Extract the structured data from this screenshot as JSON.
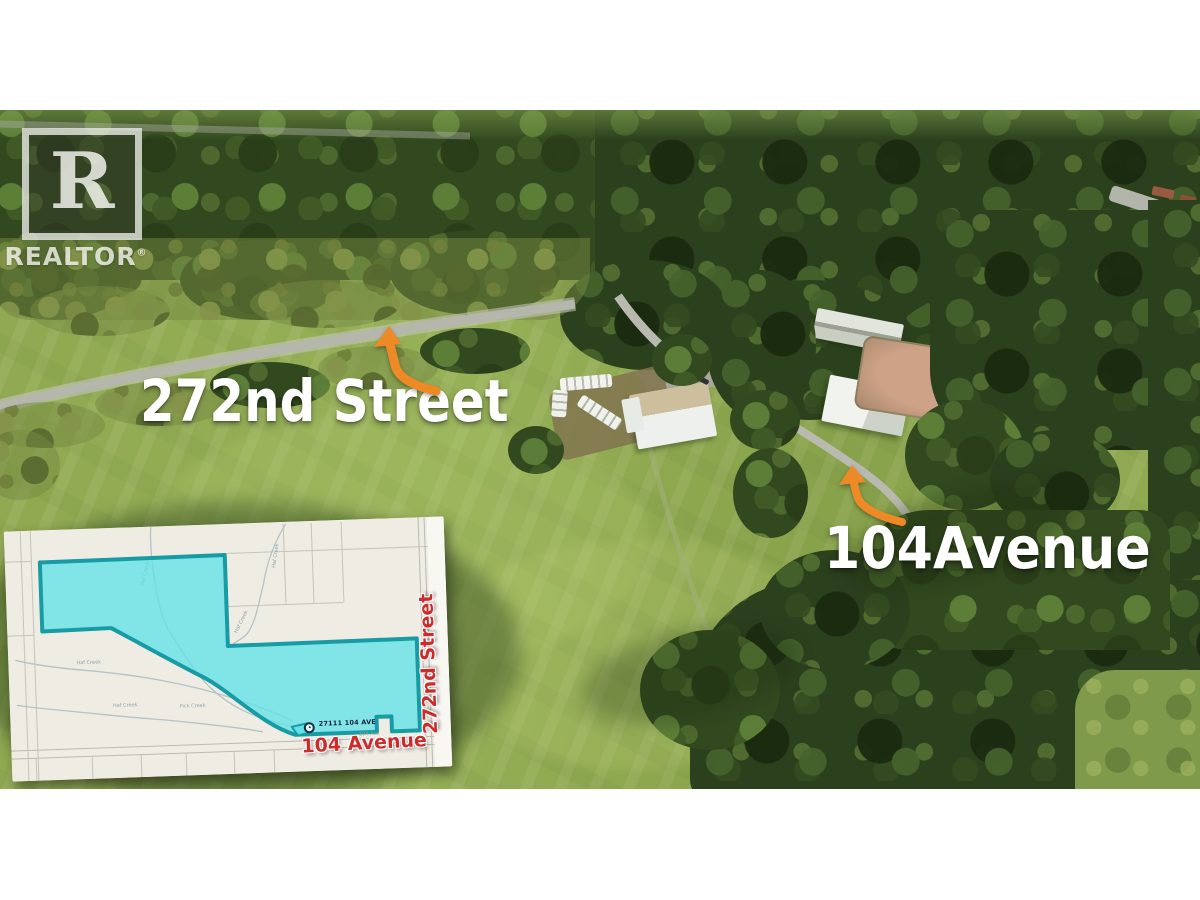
{
  "watermark": {
    "emblem_letter": "R",
    "brand": "REALTOR",
    "registered_mark": "®"
  },
  "labels": {
    "street_main": "272nd Street",
    "avenue_main": "104Avenue"
  },
  "map_inset": {
    "pin_address": "27111 104 AVE",
    "bottom_road_red": "104 Avenue",
    "right_road_red": "272nd Street",
    "small_road_gray": "104 Ave",
    "creek_labels": [
      "Haf Creek",
      "Haf Creek",
      "Haf Creek",
      "Haf Creek",
      "Haf Creek",
      "Fick Creek"
    ],
    "colors": {
      "parcel_fill": "#62e1e7",
      "parcel_outline": "#179ba4",
      "red_label": "#ce2b2b",
      "map_bg": "#efece4"
    }
  },
  "photo": {
    "colors": {
      "arrow_orange": "#ee8a26",
      "field_green": "#8ca74f",
      "forest_green": "#33491f",
      "road_gray": "#b5b7ac",
      "arena_sand": "#c29a79"
    }
  }
}
